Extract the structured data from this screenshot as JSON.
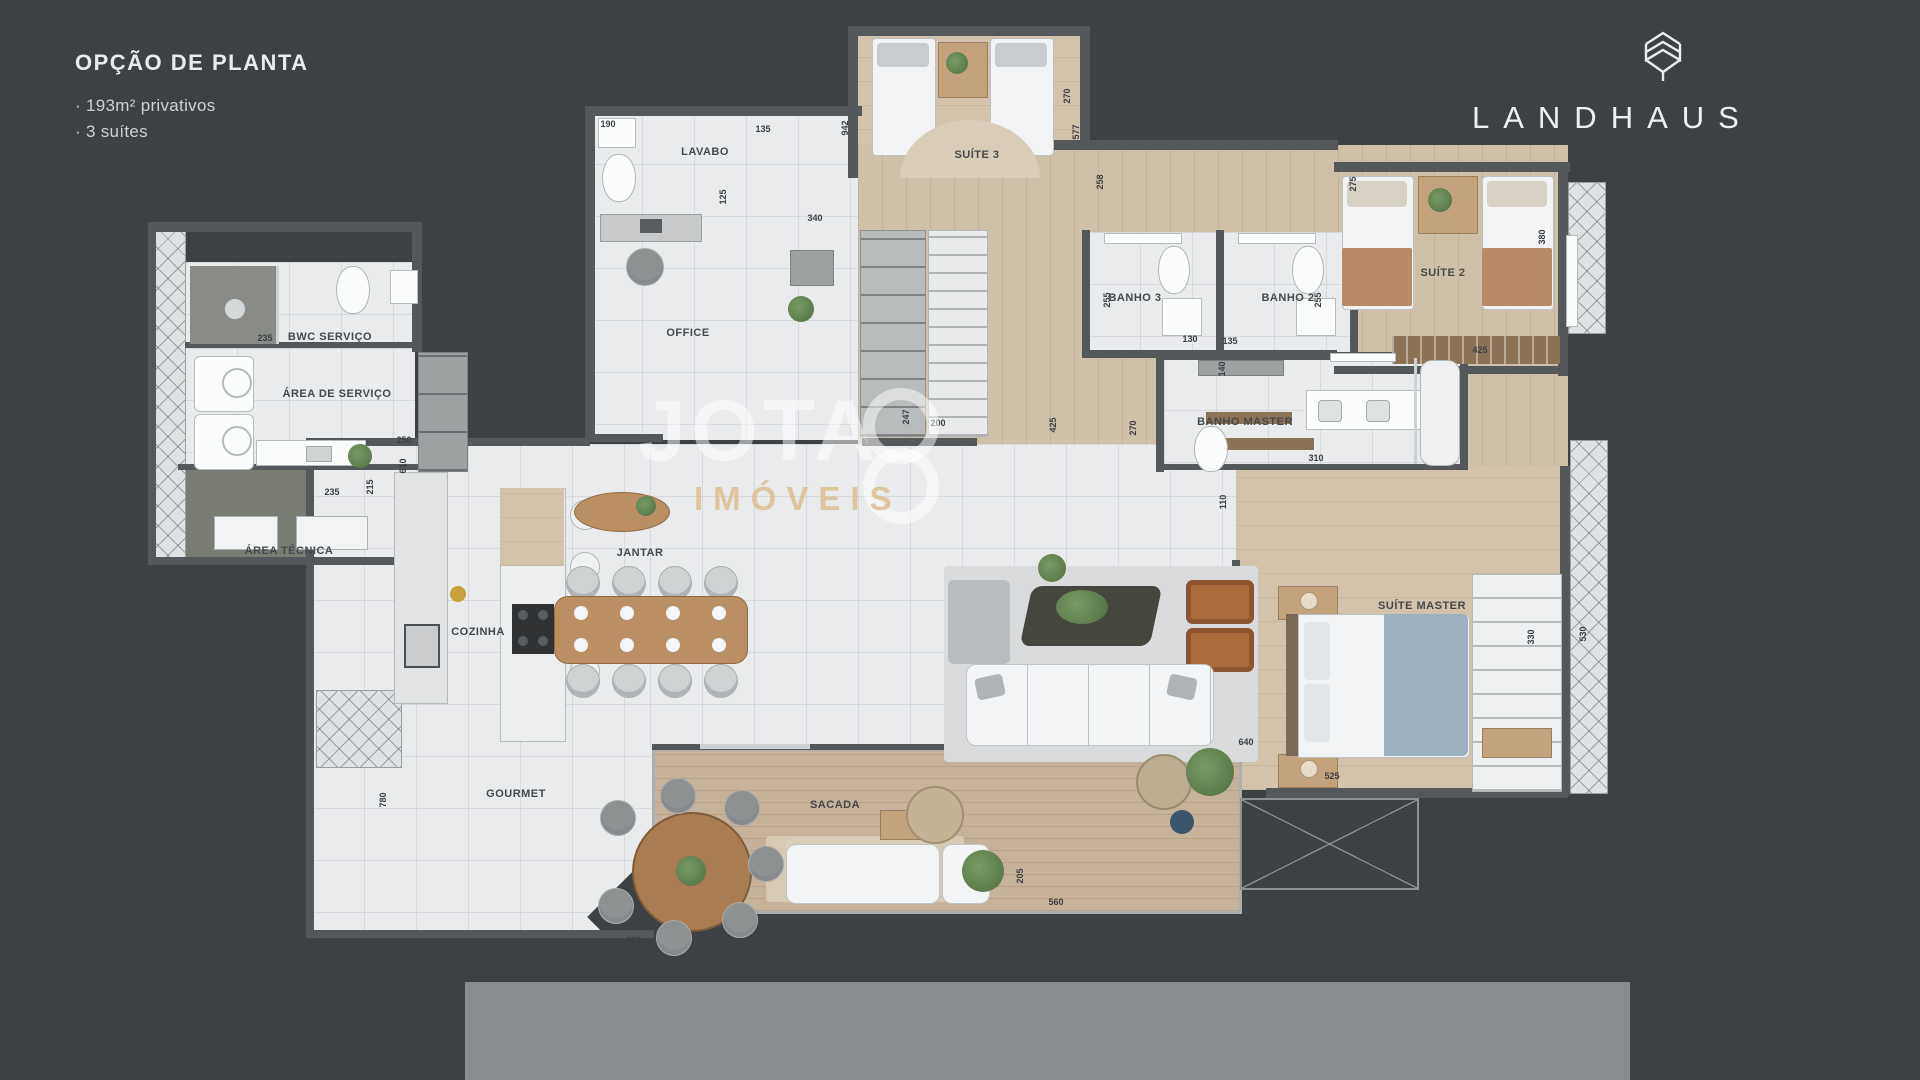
{
  "header": {
    "title": "OPÇÃO DE PLANTA",
    "bullet1": "· 193m² privativos",
    "bullet2": "· 3 suítes"
  },
  "brand": {
    "name": "LANDHAUS"
  },
  "watermark": {
    "word": "JOTA",
    "sub": "IMÓVEIS"
  },
  "colors": {
    "background": "#3e4144",
    "wall": "#54585b",
    "marble_floor": "#e9ebec",
    "wood_floor": "#cfc0a9",
    "deck_floor": "#c6b29a",
    "bottom_bar": "#898c8f",
    "watermark_white": "rgba(255,255,255,0.5)",
    "watermark_tan": "#dbba8a"
  },
  "plan": {
    "room_labels": [
      {
        "id": "lavabo",
        "label": "LAVABO",
        "x": 705,
        "y": 152
      },
      {
        "id": "suite-3",
        "label": "SUÍTE 3",
        "x": 977,
        "y": 155
      },
      {
        "id": "office",
        "label": "OFFICE",
        "x": 688,
        "y": 333
      },
      {
        "id": "bwc-servico",
        "label": "BWC SERVIÇO",
        "x": 330,
        "y": 337
      },
      {
        "id": "area-de-servico",
        "label": "ÁREA DE SERVIÇO",
        "x": 337,
        "y": 394
      },
      {
        "id": "area-tecnica",
        "label": "ÁREA TÉCNICA",
        "x": 289,
        "y": 551
      },
      {
        "id": "banho-3",
        "label": "BANHO 3",
        "x": 1135,
        "y": 298
      },
      {
        "id": "banho-2",
        "label": "BANHO 2",
        "x": 1288,
        "y": 298
      },
      {
        "id": "suite-2",
        "label": "SUÍTE 2",
        "x": 1443,
        "y": 273
      },
      {
        "id": "banho-master",
        "label": "BANHO MASTER",
        "x": 1245,
        "y": 422
      },
      {
        "id": "cozinha",
        "label": "COZINHA",
        "x": 478,
        "y": 632
      },
      {
        "id": "jantar",
        "label": "JANTAR",
        "x": 640,
        "y": 553
      },
      {
        "id": "suite-master",
        "label": "SUÍTE MASTER",
        "x": 1422,
        "y": 606
      },
      {
        "id": "gourmet",
        "label": "GOURMET",
        "x": 516,
        "y": 794
      },
      {
        "id": "sacada",
        "label": "SACADA",
        "x": 835,
        "y": 805
      }
    ],
    "dimensions": [
      {
        "v": "190",
        "x": 608,
        "y": 124,
        "vert": false
      },
      {
        "v": "135",
        "x": 763,
        "y": 129,
        "vert": false
      },
      {
        "v": "942",
        "x": 845,
        "y": 128,
        "vert": true
      },
      {
        "v": "270",
        "x": 1067,
        "y": 96,
        "vert": true
      },
      {
        "v": "577",
        "x": 1076,
        "y": 132,
        "vert": true
      },
      {
        "v": "125",
        "x": 723,
        "y": 197,
        "vert": true
      },
      {
        "v": "340",
        "x": 815,
        "y": 218,
        "vert": false
      },
      {
        "v": "235",
        "x": 519,
        "y": 280,
        "vert": true
      },
      {
        "v": "225",
        "x": 549,
        "y": 280,
        "vert": true
      },
      {
        "v": "235",
        "x": 265,
        "y": 338,
        "vert": false
      },
      {
        "v": "250",
        "x": 404,
        "y": 440,
        "vert": false
      },
      {
        "v": "610",
        "x": 403,
        "y": 466,
        "vert": true
      },
      {
        "v": "235",
        "x": 332,
        "y": 492,
        "vert": false
      },
      {
        "v": "215",
        "x": 370,
        "y": 487,
        "vert": true
      },
      {
        "v": "247",
        "x": 906,
        "y": 417,
        "vert": true
      },
      {
        "v": "200",
        "x": 938,
        "y": 423,
        "vert": false
      },
      {
        "v": "258",
        "x": 1100,
        "y": 182,
        "vert": true
      },
      {
        "v": "255",
        "x": 1107,
        "y": 300,
        "vert": true
      },
      {
        "v": "255",
        "x": 1318,
        "y": 300,
        "vert": true
      },
      {
        "v": "130",
        "x": 1190,
        "y": 339,
        "vert": false
      },
      {
        "v": "135",
        "x": 1230,
        "y": 341,
        "vert": false
      },
      {
        "v": "275",
        "x": 1353,
        "y": 184,
        "vert": true
      },
      {
        "v": "380",
        "x": 1542,
        "y": 237,
        "vert": true
      },
      {
        "v": "425",
        "x": 1480,
        "y": 350,
        "vert": false
      },
      {
        "v": "270",
        "x": 1133,
        "y": 428,
        "vert": true
      },
      {
        "v": "140",
        "x": 1222,
        "y": 369,
        "vert": true
      },
      {
        "v": "110",
        "x": 1223,
        "y": 502,
        "vert": true
      },
      {
        "v": "310",
        "x": 1316,
        "y": 458,
        "vert": false
      },
      {
        "v": "425",
        "x": 1053,
        "y": 425,
        "vert": true
      },
      {
        "v": "640",
        "x": 1246,
        "y": 742,
        "vert": false
      },
      {
        "v": "525",
        "x": 1332,
        "y": 776,
        "vert": false
      },
      {
        "v": "205",
        "x": 1020,
        "y": 876,
        "vert": true
      },
      {
        "v": "560",
        "x": 1056,
        "y": 902,
        "vert": false
      },
      {
        "v": "420",
        "x": 633,
        "y": 940,
        "vert": false
      },
      {
        "v": "780",
        "x": 383,
        "y": 800,
        "vert": true
      },
      {
        "v": "330",
        "x": 1531,
        "y": 637,
        "vert": true
      },
      {
        "v": "530",
        "x": 1583,
        "y": 634,
        "vert": true
      }
    ]
  }
}
